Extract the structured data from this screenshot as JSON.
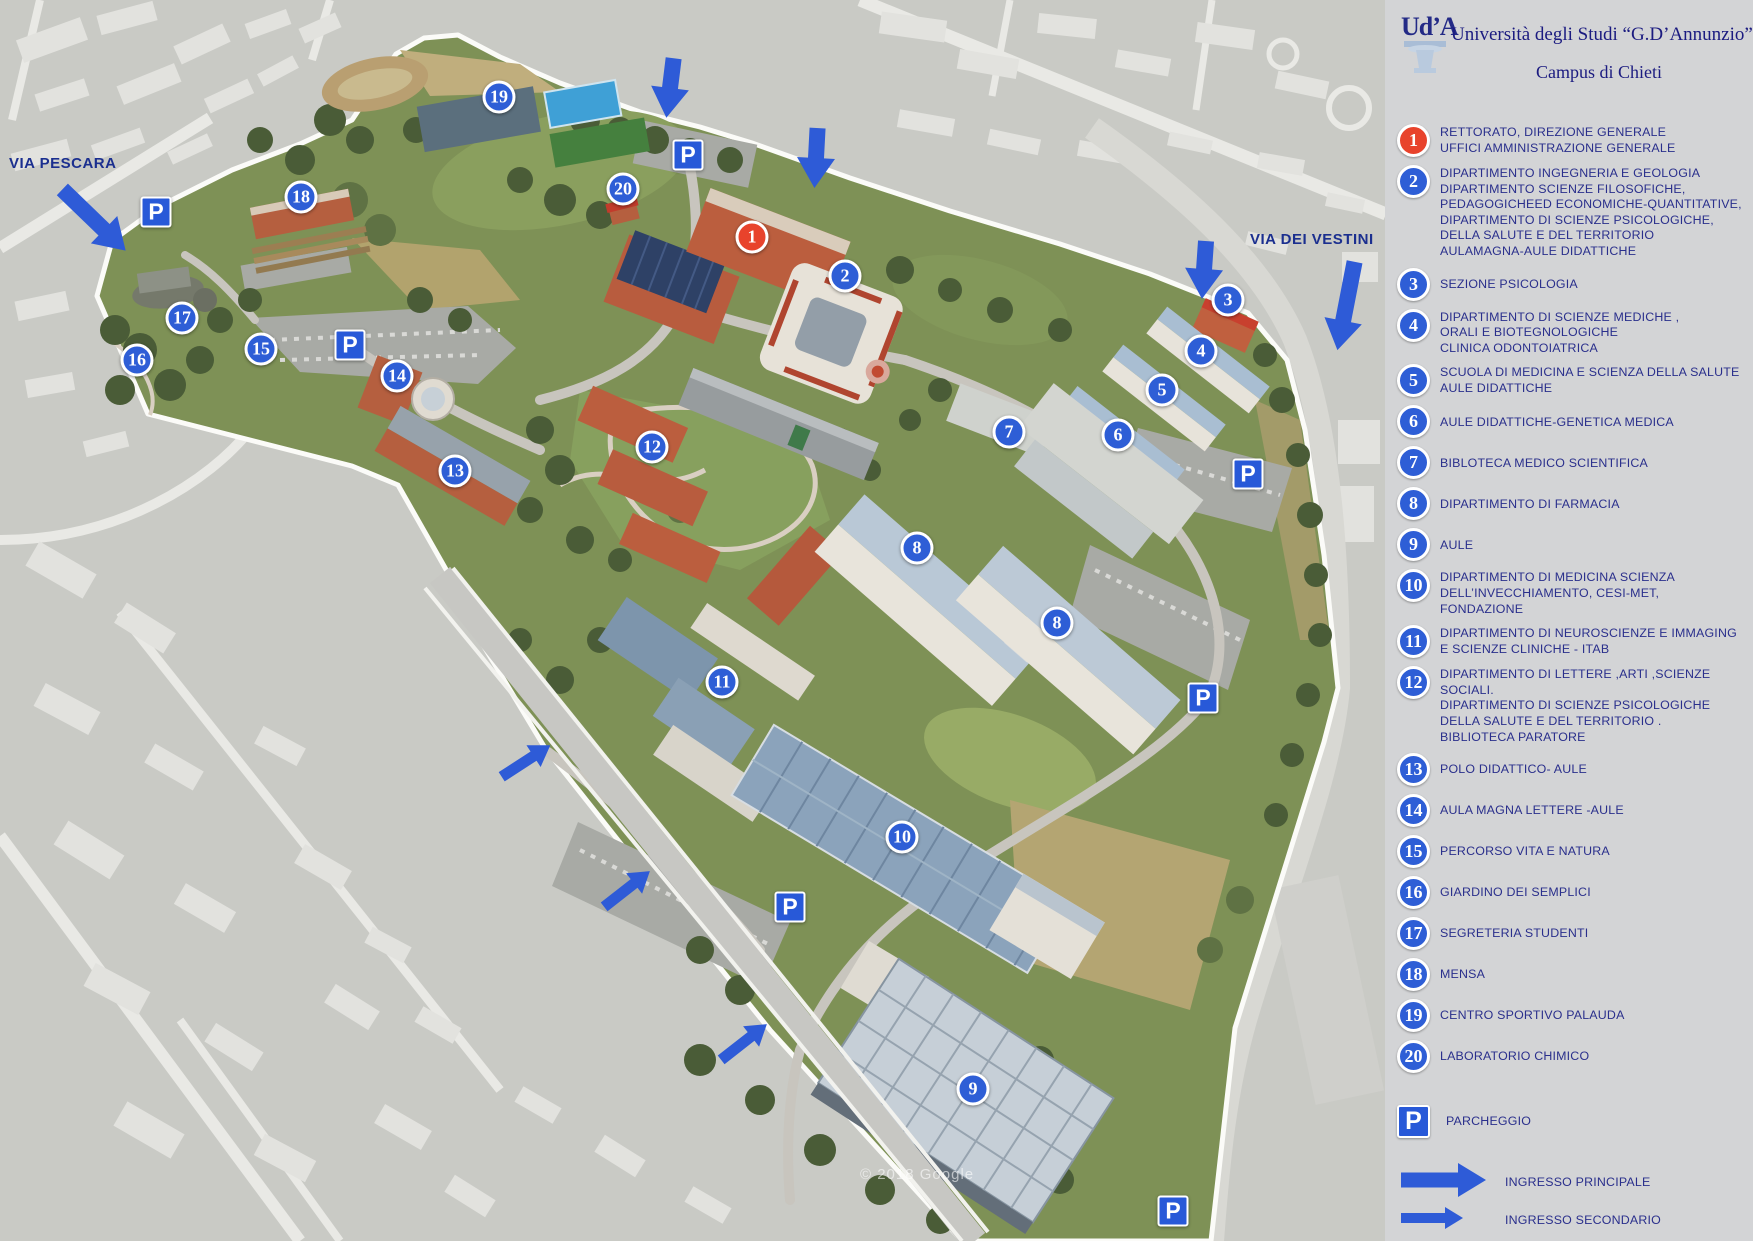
{
  "colors": {
    "accent_blue": "#2e5ed6",
    "marker_red": "#e8432c",
    "arrow_blue": "#2e5bd7",
    "navy_text": "#2a2f8c",
    "sidebar_bg": "#d3d4d6"
  },
  "header": {
    "logo_text": "Ud’A",
    "university": "Università degli Studi “G.D’Annunzio”",
    "campus": "Campus di Chieti"
  },
  "map": {
    "street_labels": [
      {
        "id": "via-pescara",
        "text": "VIA PESCARA",
        "x": 9,
        "y": 155
      },
      {
        "id": "via-dei-vestini",
        "text": "VIA DEI VESTINI",
        "x": 1250,
        "y": 231
      }
    ],
    "watermark": "© 2018 Google",
    "markers": [
      {
        "num": "1",
        "x": 752,
        "y": 237,
        "red": true
      },
      {
        "num": "2",
        "x": 845,
        "y": 276
      },
      {
        "num": "3",
        "x": 1228,
        "y": 300
      },
      {
        "num": "4",
        "x": 1201,
        "y": 351
      },
      {
        "num": "5",
        "x": 1162,
        "y": 390
      },
      {
        "num": "6",
        "x": 1118,
        "y": 435
      },
      {
        "num": "7",
        "x": 1009,
        "y": 432
      },
      {
        "num": "8",
        "x": 917,
        "y": 548
      },
      {
        "num": "8",
        "x": 1057,
        "y": 623
      },
      {
        "num": "9",
        "x": 973,
        "y": 1089
      },
      {
        "num": "10",
        "x": 902,
        "y": 837
      },
      {
        "num": "11",
        "x": 722,
        "y": 682
      },
      {
        "num": "12",
        "x": 652,
        "y": 447
      },
      {
        "num": "13",
        "x": 455,
        "y": 471
      },
      {
        "num": "14",
        "x": 397,
        "y": 376
      },
      {
        "num": "15",
        "x": 261,
        "y": 349
      },
      {
        "num": "16",
        "x": 137,
        "y": 360
      },
      {
        "num": "17",
        "x": 182,
        "y": 318
      },
      {
        "num": "18",
        "x": 301,
        "y": 197
      },
      {
        "num": "19",
        "x": 499,
        "y": 97
      },
      {
        "num": "20",
        "x": 623,
        "y": 189
      }
    ],
    "parking": [
      {
        "x": 688,
        "y": 155
      },
      {
        "x": 156,
        "y": 212
      },
      {
        "x": 350,
        "y": 345
      },
      {
        "x": 1248,
        "y": 474
      },
      {
        "x": 1203,
        "y": 698
      },
      {
        "x": 790,
        "y": 907
      },
      {
        "x": 1173,
        "y": 1211
      }
    ],
    "entrances": [
      {
        "kind": "main",
        "x": 94,
        "y": 220,
        "angle": 44,
        "len": 88
      },
      {
        "kind": "main",
        "x": 670,
        "y": 88,
        "angle": 97,
        "len": 60
      },
      {
        "kind": "main",
        "x": 816,
        "y": 158,
        "angle": 93,
        "len": 60
      },
      {
        "kind": "main",
        "x": 1204,
        "y": 270,
        "angle": 94,
        "len": 58
      },
      {
        "kind": "main",
        "x": 1346,
        "y": 306,
        "angle": 101,
        "len": 90
      },
      {
        "kind": "secondary",
        "x": 526,
        "y": 761,
        "angle": -33,
        "len": 58
      },
      {
        "kind": "secondary",
        "x": 627,
        "y": 889,
        "angle": -38,
        "len": 58
      },
      {
        "kind": "secondary",
        "x": 744,
        "y": 1042,
        "angle": -38,
        "len": 58
      }
    ]
  },
  "legend": {
    "items": [
      {
        "num": "1",
        "red": true,
        "lines": [
          "RETTORATO, DIREZIONE GENERALE",
          "UFFICI AMMINISTRAZIONE GENERALE"
        ]
      },
      {
        "num": "2",
        "lines": [
          "DIPARTIMENTO INGEGNERIA E GEOLOGIA",
          "DIPARTIMENTO SCIENZE FILOSOFICHE,",
          "PEDAGOGICHEED ECONOMICHE-QUANTITATIVE,",
          "DIPARTIMENTO DI SCIENZE PSICOLOGICHE,",
          "DELLA SALUTE E DEL TERRITORIO",
          "AULAMAGNA-AULE DIDATTICHE"
        ]
      },
      {
        "num": "3",
        "lines": [
          " SEZIONE PSICOLOGIA"
        ]
      },
      {
        "num": "4",
        "lines": [
          "DIPARTIMENTO DI SCIENZE MEDICHE ,",
          "ORALI E BIOTEGNOLOGICHE",
          "CLINICA ODONTOIATRICA"
        ]
      },
      {
        "num": "5",
        "lines": [
          "SCUOLA DI MEDICINA E SCIENZA DELLA SALUTE",
          "AULE DIDATTICHE"
        ]
      },
      {
        "num": "6",
        "lines": [
          "AULE DIDATTICHE-GENETICA MEDICA"
        ]
      },
      {
        "num": "7",
        "lines": [
          "BIBLOTECA MEDICO SCIENTIFICA"
        ]
      },
      {
        "num": "8",
        "lines": [
          "DIPARTIMENTO DI FARMACIA"
        ]
      },
      {
        "num": "9",
        "lines": [
          "AULE"
        ]
      },
      {
        "num": "10",
        "lines": [
          "DIPARTIMENTO DI MEDICINA SCIENZA",
          "DELL’INVECCHIAMENTO,  CESI-MET,",
          "FONDAZIONE"
        ]
      },
      {
        "num": "11",
        "lines": [
          "DIPARTIMENTO DI NEUROSCIENZE E IMMAGING",
          "E SCIENZE CLINICHE - ITAB"
        ]
      },
      {
        "num": "12",
        "lines": [
          "DIPARTIMENTO DI  LETTERE ,ARTI ,SCIENZE",
          "SOCIALI.",
          "DIPARTIMENTO DI SCIENZE PSICOLOGICHE",
          "DELLA SALUTE E DEL TERRITORIO .",
          "BIBLIOTECA PARATORE"
        ]
      },
      {
        "num": "13",
        "lines": [
          "POLO DIDATTICO- AULE"
        ]
      },
      {
        "num": "14",
        "lines": [
          "AULA MAGNA LETTERE -AULE"
        ]
      },
      {
        "num": "15",
        "lines": [
          "PERCORSO VITA  E NATURA"
        ]
      },
      {
        "num": "16",
        "lines": [
          "GIARDINO DEI SEMPLICI"
        ]
      },
      {
        "num": "17",
        "lines": [
          "SEGRETERIA STUDENTI"
        ]
      },
      {
        "num": "18",
        "lines": [
          "MENSA"
        ]
      },
      {
        "num": "19",
        "lines": [
          "CENTRO SPORTIVO PALAUDA"
        ]
      },
      {
        "num": "20",
        "lines": [
          "LABORATORIO CHIMICO"
        ]
      }
    ],
    "parking": {
      "icon": "P",
      "label": "PARCHEGGIO"
    },
    "entrances": [
      {
        "kind": "main",
        "label": "INGRESSO PRINCIPALE"
      },
      {
        "kind": "secondary",
        "label": "INGRESSO SECONDARIO"
      }
    ]
  }
}
